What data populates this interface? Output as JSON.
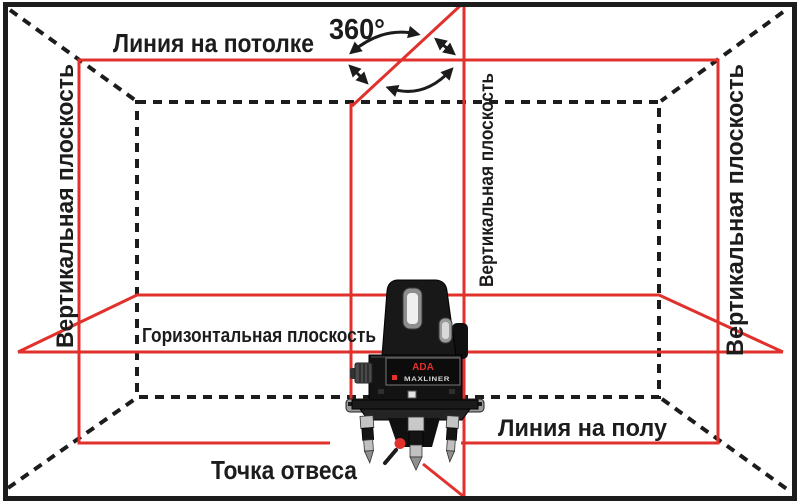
{
  "labels": {
    "ceiling_line": "Линия на потолке",
    "rotation_angle": "360°",
    "vertical_plane_left": "Вертикальная плоскость",
    "vertical_plane_middle": "Вертикальная плоскость",
    "vertical_plane_right": "Вертикальная плоскость",
    "horizontal_plane": "Горизонтальная плоскость",
    "floor_line": "Линия на полу",
    "plumb_point": "Точка отвеса"
  },
  "device": {
    "brand": "ADA",
    "model": "MAXLINER"
  },
  "colors": {
    "laser_red": "#e0312d",
    "ink_black": "#1c1c1c",
    "background": "#ffffff"
  }
}
